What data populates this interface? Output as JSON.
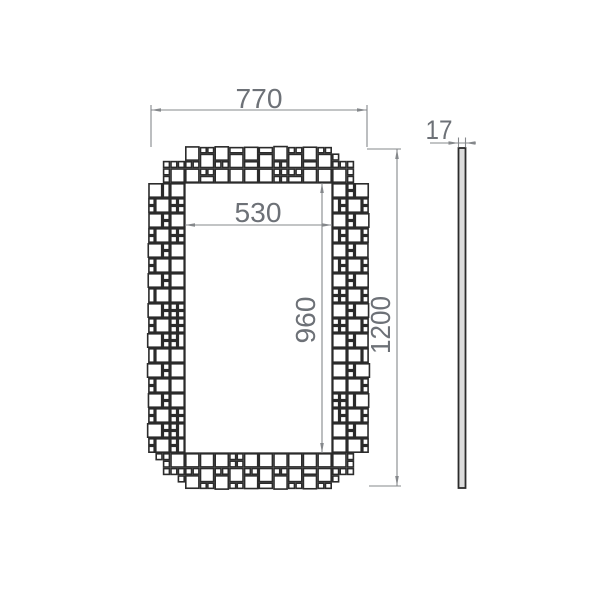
{
  "dimensions": {
    "outer_width": {
      "label": "770"
    },
    "inner_width": {
      "label": "530"
    },
    "inner_height": {
      "label": "960"
    },
    "outer_height": {
      "label": "1200"
    },
    "thickness": {
      "label": "17"
    }
  },
  "colors": {
    "dimension_lines": "#85888b",
    "dimension_text": "#6d7177",
    "tile_stroke": "#2b2b2b",
    "tile_fill": "#ffffff",
    "side_bar_fill": "#dcdcdc",
    "background": "#ffffff"
  }
}
